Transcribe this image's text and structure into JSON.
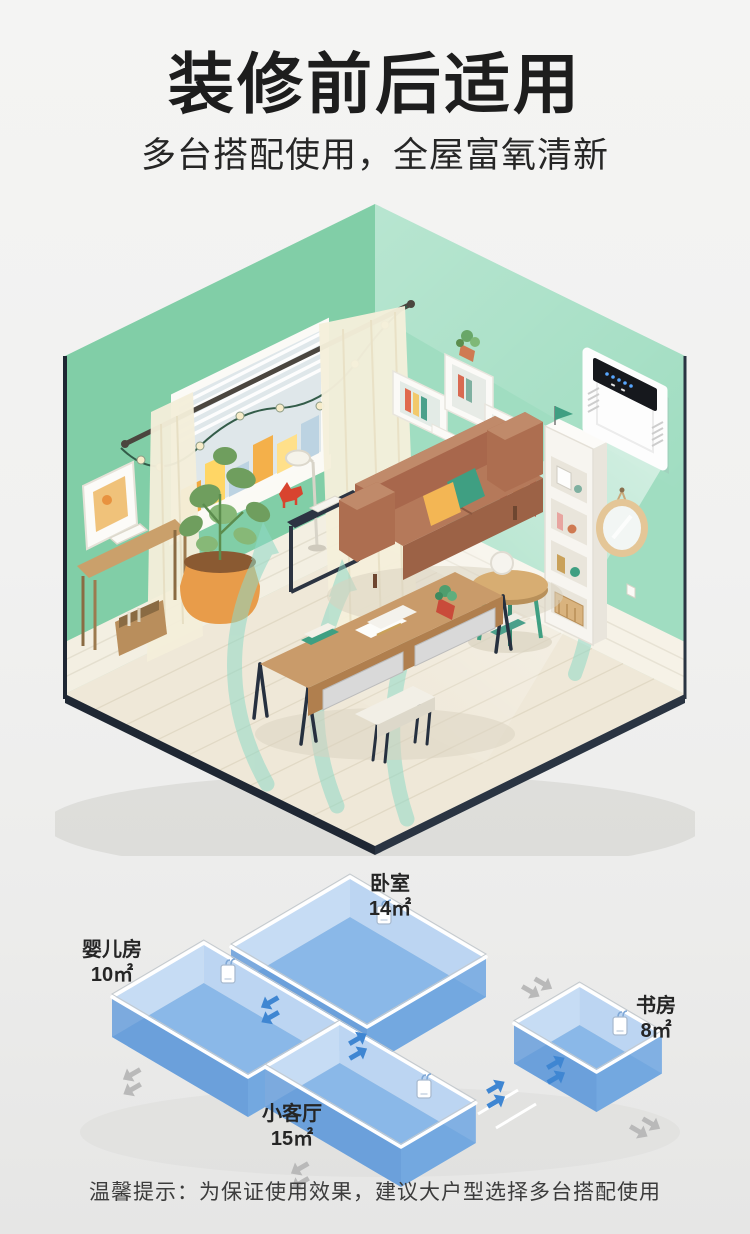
{
  "header": {
    "title": "装修前后适用",
    "subtitle": "多台搭配使用，全屋富氧清新"
  },
  "scene": {
    "name": "isometric-living-room",
    "device": "wall-mounted-fresh-air-purifier",
    "airflow": "teal-fresh-air-streams"
  },
  "floorplan": {
    "rooms": [
      {
        "id": "nursery",
        "name": "婴儿房",
        "area": "10㎡"
      },
      {
        "id": "bedroom",
        "name": "卧室",
        "area": "14㎡"
      },
      {
        "id": "living",
        "name": "小客厅",
        "area": "15㎡"
      },
      {
        "id": "study",
        "name": "书房",
        "area": "8㎡"
      }
    ],
    "device_count": 4
  },
  "footer": {
    "tip": "温馨提示：为保证使用效果，建议大户型选择多台搭配使用"
  },
  "colors": {
    "wall_green_left": "#81cea7",
    "wall_green_right": "#a0ddc1",
    "floor_cream": "#efe8d8",
    "trim_dark": "#1f2733",
    "airflow_teal": "#8fd9c6",
    "sofa_brown": "#b5795a",
    "pillow_yellow": "#f3b654",
    "pillow_teal": "#3f9f82",
    "plan_floor_blue": "#8ab8e8",
    "plan_wall_light": "#c6dcf4",
    "plan_wall_dark": "#6ba2dd",
    "arrow_blue": "#3f86d2",
    "arrow_gray": "#b9b9b9"
  }
}
